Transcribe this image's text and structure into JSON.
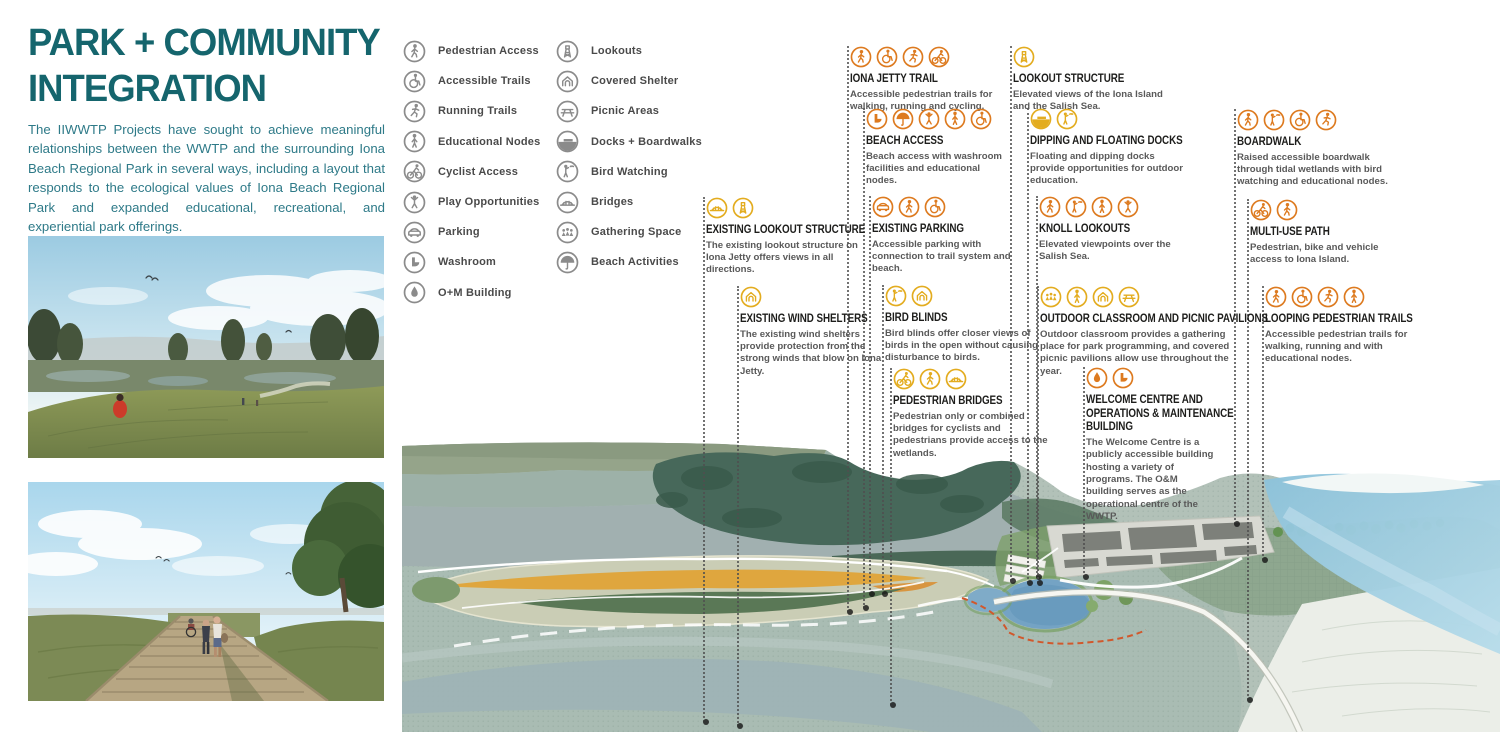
{
  "board": {
    "title_line1": "PARK + COMMUNITY",
    "title_line2": "INTEGRATION",
    "intro": "The IIWWTP Projects have sought to achieve meaningful relationships between the WWTP and the surrounding Iona Beach Regional Park in several ways, including a layout that responds to the ecological values of Iona Beach Regional Park and expanded educational, recreational, and experiential park offerings."
  },
  "colors": {
    "title_teal": "#15656d",
    "intro_teal": "#2e7a88",
    "callout_orange": "#dd7a1f",
    "callout_gold": "#e3ac1f",
    "legend_gray": "#8b8b8b",
    "callout_title_color": "#1d1d1b",
    "callout_text_color": "#595959"
  },
  "legend": {
    "column1": [
      {
        "label": "Pedestrian Access",
        "icon": "pedestrian"
      },
      {
        "label": "Accessible Trails",
        "icon": "wheelchair"
      },
      {
        "label": "Running Trails",
        "icon": "runner"
      },
      {
        "label": "Educational Nodes",
        "icon": "education"
      },
      {
        "label": "Cyclist Access",
        "icon": "cyclist"
      },
      {
        "label": "Play Opportunities",
        "icon": "play"
      },
      {
        "label": "Parking",
        "icon": "car"
      },
      {
        "label": "Washroom",
        "icon": "washroom"
      },
      {
        "label": "O+M Building",
        "icon": "drop"
      }
    ],
    "column2": [
      {
        "label": "Lookouts",
        "icon": "lookout"
      },
      {
        "label": "Covered Shelter",
        "icon": "shelter"
      },
      {
        "label": "Picnic Areas",
        "icon": "picnic"
      },
      {
        "label": "Docks + Boardwalks",
        "icon": "dock"
      },
      {
        "label": "Bird Watching",
        "icon": "birdwatcher"
      },
      {
        "label": "Bridges",
        "icon": "bridge"
      },
      {
        "label": "Gathering Space",
        "icon": "gathering"
      },
      {
        "label": "Beach Activities",
        "icon": "umbrella"
      }
    ]
  },
  "callouts": [
    {
      "id": "iona-jetty-trail",
      "title_lines": [
        "IONA JETTY TRAIL"
      ],
      "description": "Accessible pedestrian trails for walking, running and cycling.",
      "icons": [
        "pedestrian",
        "wheelchair",
        "runner",
        "cyclist"
      ],
      "color": "orange",
      "x": 850,
      "y": 46,
      "width": 150,
      "leader": {
        "x": 847,
        "top": 46,
        "bottom": 612
      }
    },
    {
      "id": "beach-access",
      "title_lines": [
        "BEACH ACCESS"
      ],
      "description": "Beach access with washroom facilities and educational nodes.",
      "icons": [
        "washroom",
        "umbrella",
        "play",
        "education",
        "wheelchair"
      ],
      "color": "orange",
      "x": 866,
      "y": 108,
      "width": 142,
      "leader": {
        "x": 863,
        "top": 108,
        "bottom": 608
      }
    },
    {
      "id": "lookout-structure",
      "title_lines": [
        "LOOKOUT STRUCTURE"
      ],
      "description": "Elevated views of the Iona Island and the Salish Sea.",
      "icons": [
        "lookout"
      ],
      "color": "gold",
      "x": 1013,
      "y": 46,
      "width": 150,
      "leader": {
        "x": 1010,
        "top": 46,
        "bottom": 581
      }
    },
    {
      "id": "dipping-and-floating-docks",
      "title_lines": [
        "DIPPING AND FLOATING DOCKS"
      ],
      "description": "Floating and dipping docks provide opportunities for outdoor education.",
      "icons": [
        "dock",
        "birdwatcher"
      ],
      "color": "gold",
      "x": 1030,
      "y": 108,
      "width": 158,
      "leader": {
        "x": 1027,
        "top": 108,
        "bottom": 583
      }
    },
    {
      "id": "boardwalk",
      "title_lines": [
        "BOARDWALK"
      ],
      "description": "Raised accessible boardwalk through tidal wetlands with bird watching and educational nodes.",
      "icons": [
        "pedestrian",
        "birdwatcher",
        "wheelchair",
        "runner"
      ],
      "color": "orange",
      "x": 1237,
      "y": 109,
      "width": 162,
      "leader": {
        "x": 1234,
        "top": 109,
        "bottom": 524
      }
    },
    {
      "id": "existing-lookout-structure",
      "title_lines": [
        "EXISTING LOOKOUT STRUCTURE"
      ],
      "description": "The existing lookout structure on Iona Jetty offers views in all directions.",
      "icons": [
        "bridge",
        "lookout"
      ],
      "color": "gold",
      "x": 706,
      "y": 197,
      "width": 152,
      "leader": {
        "x": 703,
        "top": 197,
        "bottom": 722
      }
    },
    {
      "id": "existing-parking",
      "title_lines": [
        "EXISTING PARKING"
      ],
      "description": "Accessible parking with connection to trail system and beach.",
      "icons": [
        "car",
        "pedestrian",
        "wheelchair"
      ],
      "color": "orange",
      "x": 872,
      "y": 196,
      "width": 148,
      "leader": {
        "x": 869,
        "top": 196,
        "bottom": 594
      }
    },
    {
      "id": "knoll-lookouts",
      "title_lines": [
        "KNOLL LOOKOUTS"
      ],
      "description": "Elevated viewpoints over the Salish Sea.",
      "icons": [
        "pedestrian",
        "birdwatcher",
        "education",
        "play"
      ],
      "color": "orange",
      "x": 1039,
      "y": 196,
      "width": 150,
      "leader": {
        "x": 1036,
        "top": 196,
        "bottom": 577
      }
    },
    {
      "id": "multi-use-path",
      "title_lines": [
        "MULTI-USE PATH"
      ],
      "description": "Pedestrian, bike and vehicle access to Iona Island.",
      "icons": [
        "cyclist",
        "pedestrian"
      ],
      "color": "orange",
      "x": 1250,
      "y": 199,
      "width": 145,
      "leader": {
        "x": 1247,
        "top": 199,
        "bottom": 700
      }
    },
    {
      "id": "existing-wind-shelters",
      "title_lines": [
        "EXISTING WIND SHELTERS"
      ],
      "description": "The existing wind shelters provide protection from the strong winds that blow on Iona Jetty.",
      "icons": [
        "shelter"
      ],
      "color": "gold",
      "x": 740,
      "y": 286,
      "width": 150,
      "leader": {
        "x": 737,
        "top": 286,
        "bottom": 726
      }
    },
    {
      "id": "bird-blinds",
      "title_lines": [
        "BIRD BLINDS"
      ],
      "description": "Bird blinds offer closer views of birds in the open without causing disturbance to birds.",
      "icons": [
        "birdwatcher",
        "shelter"
      ],
      "color": "gold",
      "x": 885,
      "y": 285,
      "width": 156,
      "leader": {
        "x": 882,
        "top": 285,
        "bottom": 594
      }
    },
    {
      "id": "outdoor-classroom-and-picnic-pavilions",
      "title_lines": [
        "OUTDOOR CLASSROOM AND PICNIC PAVILIONS"
      ],
      "description": "Outdoor classroom provides a gathering place for park programming, and covered picnic pavilions allow use throughout the year.",
      "icons": [
        "gathering",
        "education",
        "shelter",
        "picnic"
      ],
      "color": "gold",
      "x": 1040,
      "y": 286,
      "width": 190,
      "leader": {
        "x": 1037,
        "top": 286,
        "bottom": 583
      }
    },
    {
      "id": "looping-pedestrian-trails",
      "title_lines": [
        "LOOPING PEDESTRIAN TRAILS"
      ],
      "description": "Accessible pedestrian trails for walking, running and with educational nodes.",
      "icons": [
        "pedestrian",
        "wheelchair",
        "runner",
        "education"
      ],
      "color": "orange",
      "x": 1265,
      "y": 286,
      "width": 155,
      "leader": {
        "x": 1262,
        "top": 286,
        "bottom": 560
      }
    },
    {
      "id": "pedestrian-bridges",
      "title_lines": [
        "PEDESTRIAN BRIDGES"
      ],
      "description": "Pedestrian only or combined bridges for cyclists and pedestrians provide access to the wetlands.",
      "icons": [
        "cyclist",
        "pedestrian",
        "bridge"
      ],
      "color": "gold",
      "x": 893,
      "y": 368,
      "width": 158,
      "leader": {
        "x": 890,
        "top": 368,
        "bottom": 705
      }
    },
    {
      "id": "welcome-centre-and-om-building",
      "title_lines": [
        "WELCOME CENTRE AND",
        "OPERATIONS & MAINTENANCE",
        "BUILDING"
      ],
      "description": "The Welcome Centre is a publicly accessible building hosting a variety of programs. The O&M building serves as the operational centre of the WWTP.",
      "icons": [
        "drop",
        "washroom"
      ],
      "color": "orange",
      "x": 1086,
      "y": 367,
      "width": 130,
      "leader": {
        "x": 1083,
        "top": 367,
        "bottom": 577
      }
    }
  ]
}
